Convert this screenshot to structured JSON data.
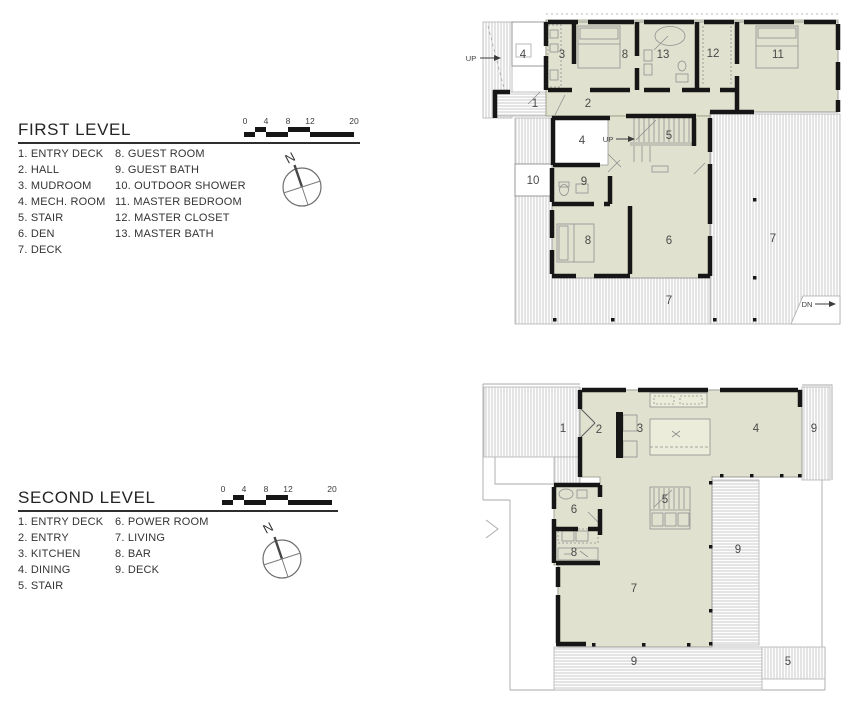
{
  "colors": {
    "room_fill": "#e0e2cf",
    "wall": "#1a1a1a",
    "deck_stripe": "#c6c6c6",
    "thin_line": "#9a9a9a"
  },
  "first_level": {
    "title": "FIRST LEVEL",
    "scale_ticks": [
      "0",
      "4",
      "8",
      "12",
      "20"
    ],
    "compass_label": "N",
    "legend_col1": [
      "1. ENTRY DECK",
      "2. HALL",
      "3. MUDROOM",
      "4. MECH. ROOM",
      "5. STAIR",
      "6. DEN",
      "7. DECK"
    ],
    "legend_col2": [
      "8. GUEST ROOM",
      "9. GUEST BATH",
      "10. OUTDOOR SHOWER",
      "11. MASTER BEDROOM",
      "12. MASTER CLOSET",
      "13. MASTER BATH"
    ],
    "plan_labels": {
      "up_deck": "UP",
      "mech_top": "4",
      "mudroom": "3",
      "guest_room_top": "8",
      "master_bath": "13",
      "master_closet": "12",
      "master_bedroom": "11",
      "entry_deck": "1",
      "hall": "2",
      "mech_mid": "4",
      "up_stair": "UP",
      "stair": "5",
      "outdoor_shower": "10",
      "guest_bath": "9",
      "guest_room": "8",
      "den": "6",
      "deck_right": "7",
      "deck_bottom": "7",
      "down": "DN"
    }
  },
  "second_level": {
    "title": "SECOND LEVEL",
    "scale_ticks": [
      "0",
      "4",
      "8",
      "12",
      "20"
    ],
    "compass_label": "N",
    "legend_col1": [
      "1. ENTRY DECK",
      "2. ENTRY",
      "3. KITCHEN",
      "4. DINING",
      "5. STAIR"
    ],
    "legend_col2": [
      "6. POWER ROOM",
      "7. LIVING",
      "8. BAR",
      "9. DECK"
    ],
    "plan_labels": {
      "entry_deck": "1",
      "entry": "2",
      "kitchen": "3",
      "dining": "4",
      "deck_top": "9",
      "stair": "5",
      "power_room": "6",
      "bar": "8",
      "living": "7",
      "deck_right": "9",
      "deck_bottom": "9",
      "outdoor_stair": "5"
    }
  }
}
